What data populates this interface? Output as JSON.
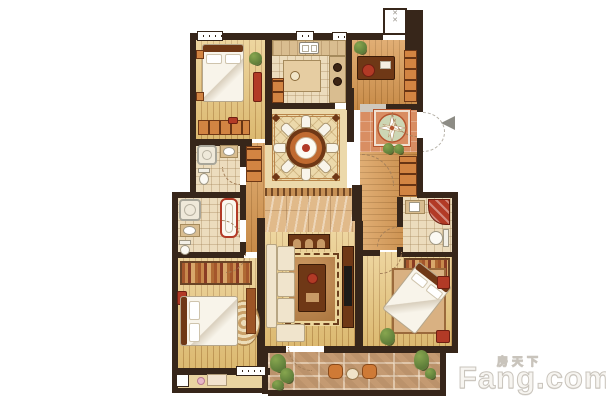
{
  "watermark": {
    "cn": "房天下",
    "en": "Fang.com"
  },
  "palette": {
    "wall": "#37261a",
    "woodA": "#e7c67b",
    "woodB": "#d99a52",
    "plankLine": "rgba(139,86,26,0.38)",
    "tile": "#ecdcbd",
    "tileLine": "rgba(160,130,85,0.35)",
    "diningBase": "#ecd9ab",
    "diningBorder": "#b9854a",
    "marble": "#e1ba8a",
    "foyerTile": "#d98e63",
    "medallion": "#b5542e",
    "medallionInner": "#cdd6b4",
    "stone": "#c49a72",
    "rugBorder": "#ecd69c",
    "rugKey": "#6b3e1d",
    "furn": "#9c5526",
    "furnDark": "#6f3816",
    "redAccent": "#b23a26",
    "cream": "#f0e4cc",
    "bedWhite": "#f8f4ea",
    "bedShadow": "#d9cfbd",
    "green": "#5d7c39",
    "greenLight": "#87a64f",
    "arrowGray": "#8d8c85",
    "arcColor": "#a5805a",
    "wmFill": "#f7f5f1",
    "wmStroke": "#c9c4bc"
  },
  "plan": {
    "type": "floorplan",
    "regions": [
      "bedroom-top-left",
      "kitchen",
      "study",
      "utility-shaft",
      "entry-foyer",
      "dining-room",
      "hallway-left",
      "hallway-marble",
      "bathroom-upper-left",
      "bathroom-lower-left",
      "bedroom-bottom-left",
      "bay-window",
      "living-room",
      "corridor-right",
      "bathroom-right",
      "walk-in-closet",
      "bedroom-bottom-right",
      "south-balcony"
    ],
    "entry_side": "right"
  }
}
